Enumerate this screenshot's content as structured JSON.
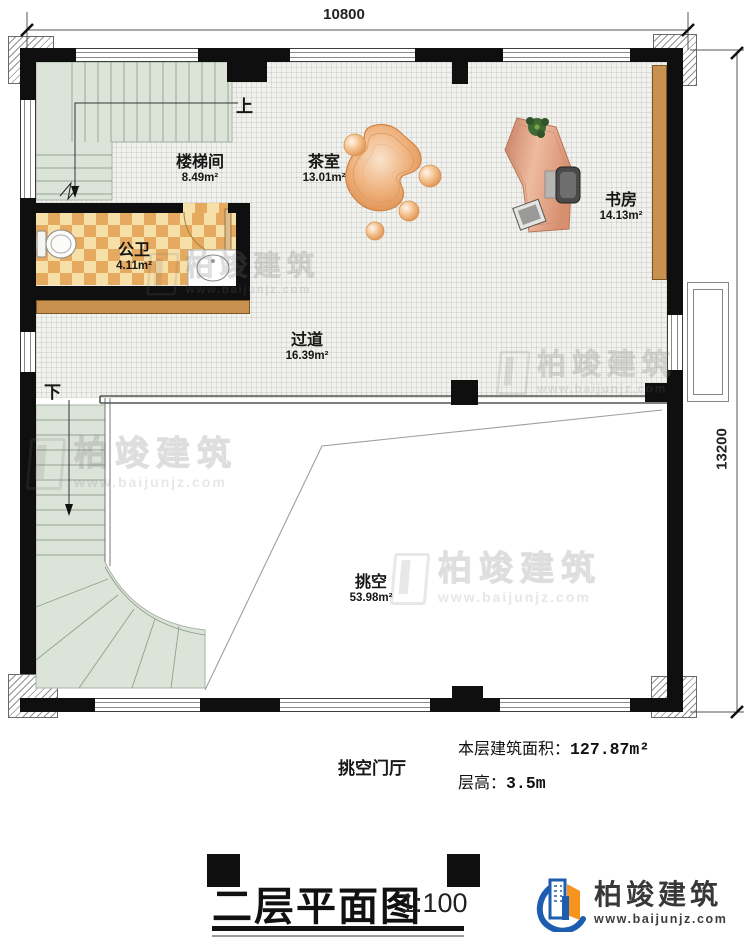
{
  "plan": {
    "title": "二层平面图",
    "scale": "1:100",
    "dim_top": "10800",
    "dim_right": "13200",
    "labels": {
      "up": "上",
      "down": "下"
    },
    "rooms": {
      "stairwell": {
        "name": "楼梯间",
        "area": "8.49m²"
      },
      "tea_room": {
        "name": "茶室",
        "area": "13.01m²"
      },
      "study": {
        "name": "书房",
        "area": "14.13m²"
      },
      "bathroom": {
        "name": "公卫",
        "area": "4.11m²"
      },
      "corridor": {
        "name": "过道",
        "area": "16.39m²"
      },
      "void": {
        "name": "挑空",
        "area": "53.98m²"
      }
    },
    "annotations": {
      "hall": "挑空门厅",
      "floor_area_label": "本层建筑面积：",
      "floor_area_value": "127.87m²",
      "floor_height_label": "层高：",
      "floor_height_value": "3.5m"
    }
  },
  "branding": {
    "company": "柏竣建筑",
    "website": "www.baijunjz.com",
    "colors": {
      "blue": "#1d5db0",
      "orange": "#f7941d"
    }
  }
}
